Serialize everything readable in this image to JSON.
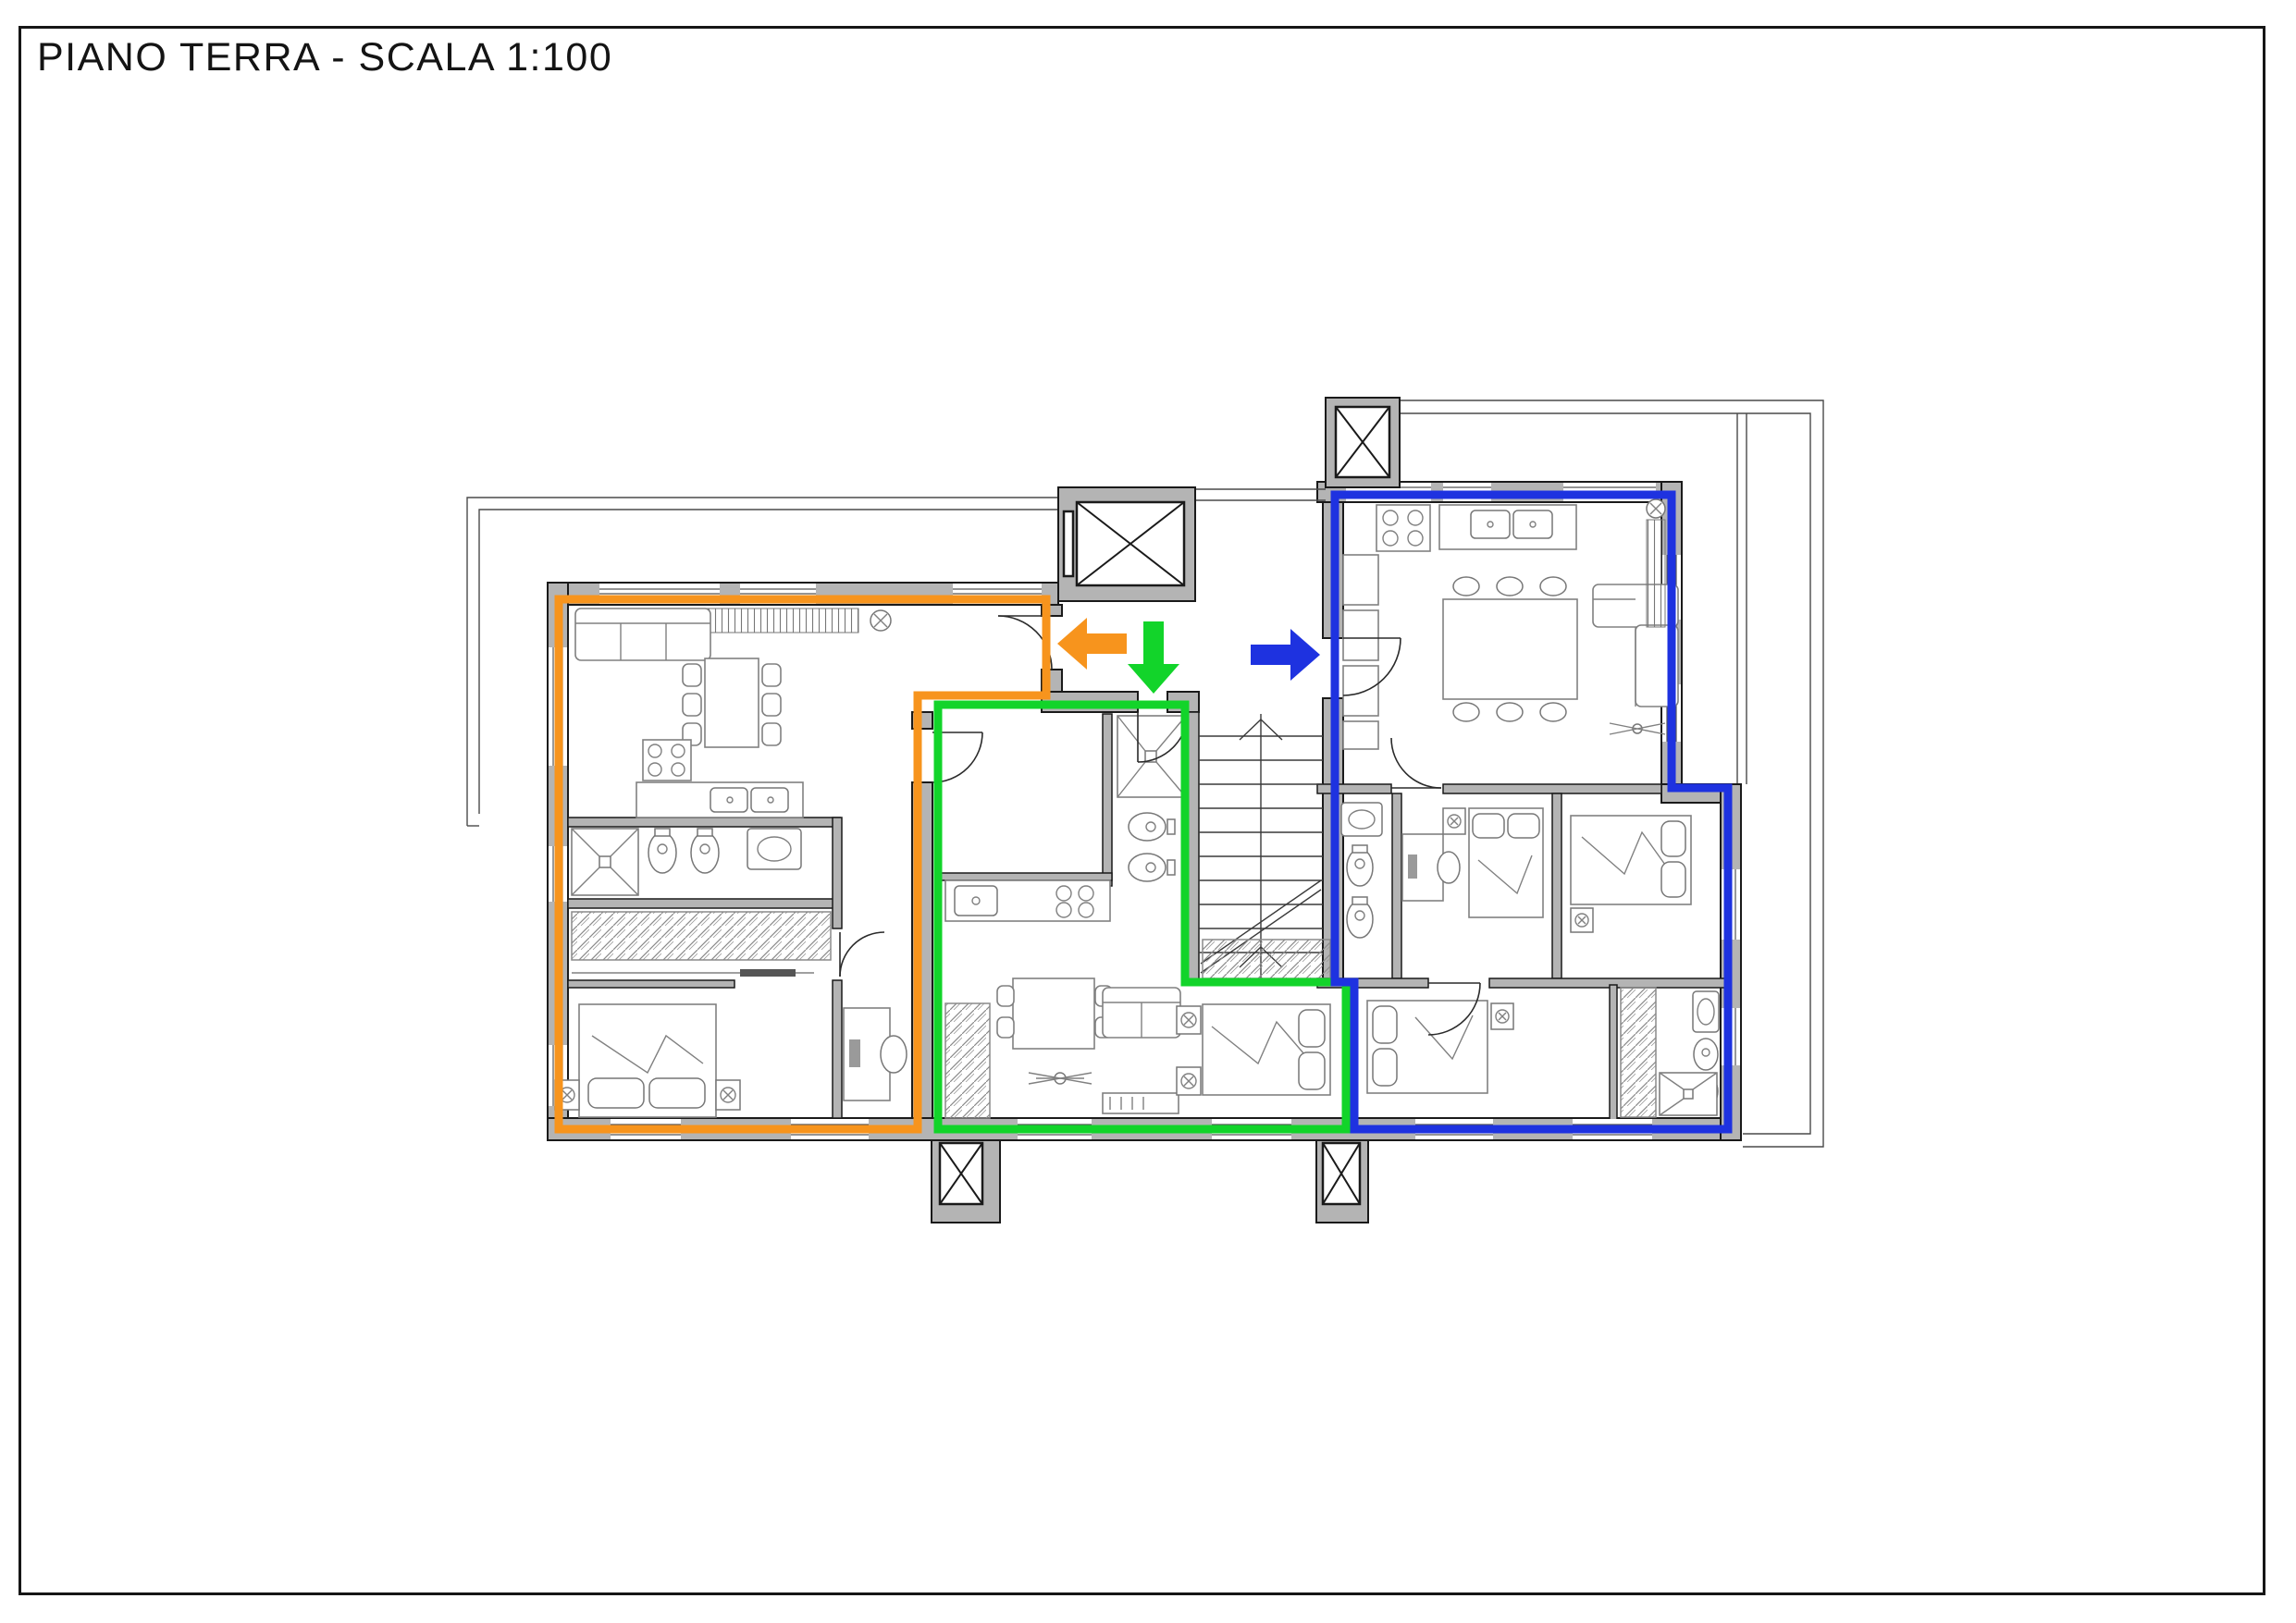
{
  "page": {
    "title": "PIANO TERRA - SCALA 1:100",
    "floor_name": "PIANO TERRA",
    "scale": "1:100"
  },
  "plan": {
    "wall_color": "#b4b4b4",
    "line_color": "#1a1a1a",
    "furniture_color": "#808080",
    "apartments": [
      {
        "id": "apartment-left",
        "outline_color": "#F7941D",
        "entrance_arrow_direction": "left"
      },
      {
        "id": "apartment-middle",
        "outline_color": "#12D42A",
        "entrance_arrow_direction": "down"
      },
      {
        "id": "apartment-right",
        "outline_color": "#1E32E0",
        "entrance_arrow_direction": "right"
      }
    ],
    "icons": [
      "elevator-icon",
      "stairs-icon",
      "shaft-icon",
      "sofa-icon",
      "bed-icon",
      "dining-table-icon",
      "shower-icon",
      "toilet-icon",
      "bidet-icon",
      "sink-icon",
      "wardrobe-icon",
      "radiator-icon",
      "stove-icon",
      "kitchen-sink-icon",
      "ceiling-fan-icon",
      "lamp-icon",
      "door-swing-icon",
      "window-icon",
      "balcony-outline"
    ]
  }
}
